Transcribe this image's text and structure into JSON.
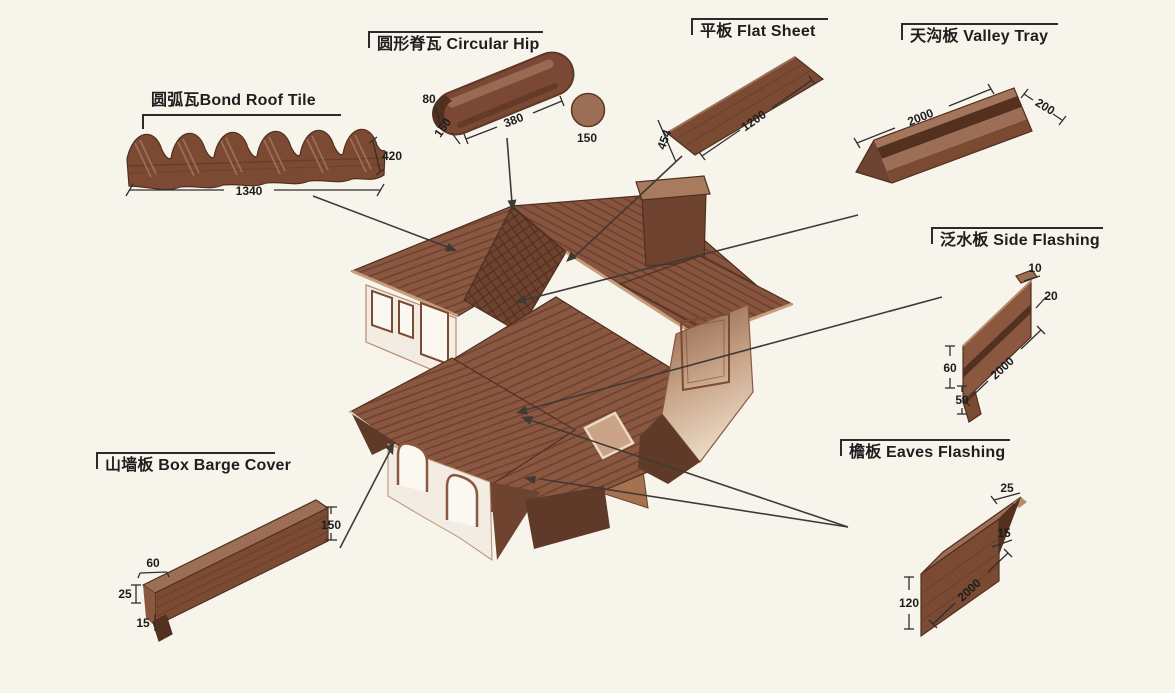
{
  "page": {
    "background_color": "#f7f4ec",
    "ink_color": "#1e1e1e",
    "tile_brown": "#8a5740",
    "dark_brown": "#54301f",
    "light_brown": "#9c6e55"
  },
  "house": {
    "name": "stone-coated-metal-roof-house"
  },
  "components": {
    "bond_roof_tile": {
      "label": "圆弧瓦Bond Roof Tile",
      "dims": {
        "length": "1340",
        "width": "420"
      }
    },
    "circular_hip": {
      "label": "圆形脊瓦 Circular Hip",
      "dims": {
        "arc_height": "80",
        "arc_width": "150",
        "length": "380",
        "end_diameter": "150"
      }
    },
    "flat_sheet": {
      "label": "平板 Flat Sheet",
      "dims": {
        "length": "1200",
        "width": "454"
      }
    },
    "valley_tray": {
      "label": "天沟板 Valley Tray",
      "dims": {
        "length": "2000",
        "width": "200"
      }
    },
    "side_flashing": {
      "label": "泛水板 Side Flashing",
      "dims": {
        "top_lip": "10",
        "fold": "20",
        "upper_face": "60",
        "length": "2000",
        "lower_face": "50"
      }
    },
    "eaves_flashing": {
      "label": "檐板 Eaves Flashing",
      "dims": {
        "top_flange": "25",
        "edge_lip": "15",
        "length": "2000",
        "face_height": "120"
      }
    },
    "box_barge_cover": {
      "label": "山墙板 Box Barge Cover",
      "dims": {
        "face_height": "150",
        "top_width": "60",
        "side_lip": "25",
        "bottom_lip": "15"
      }
    }
  }
}
